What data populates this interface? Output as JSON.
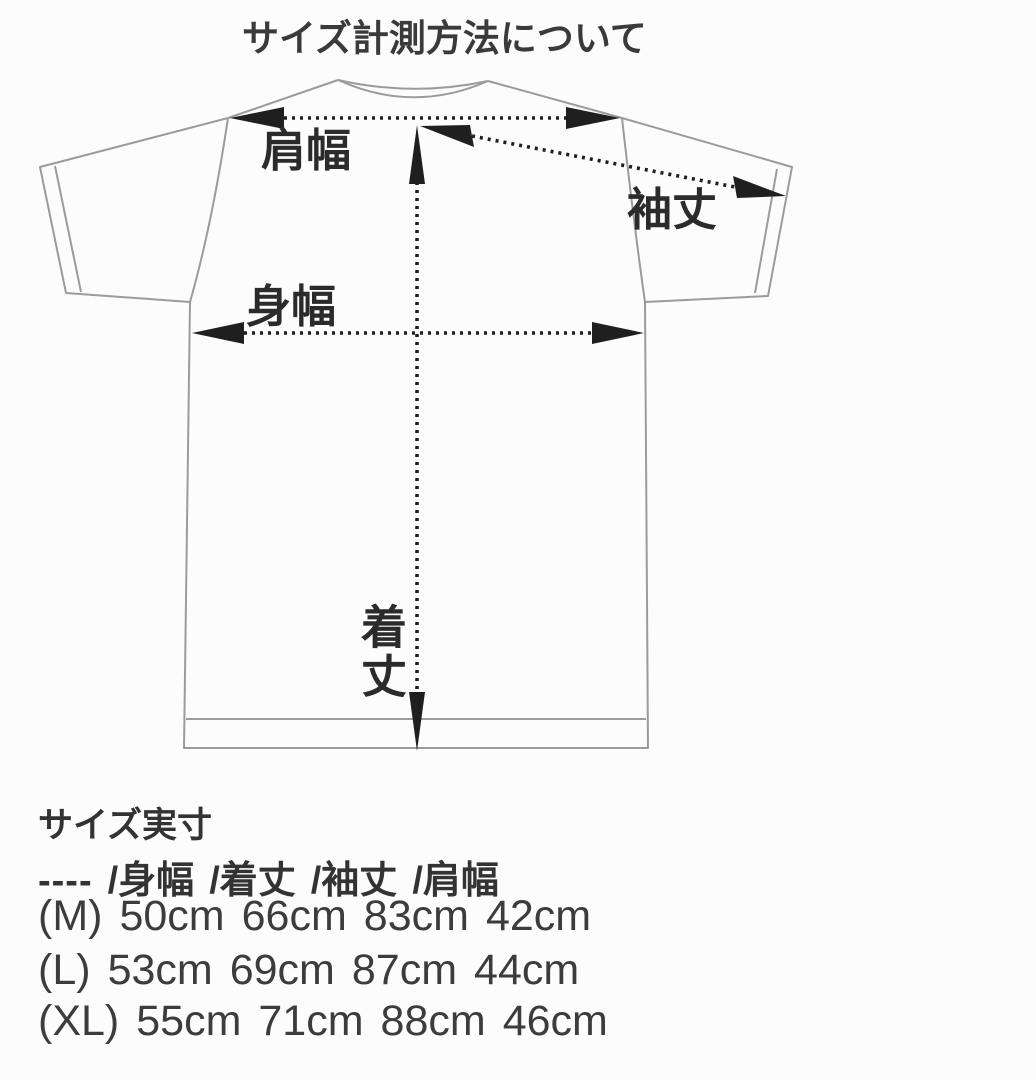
{
  "title": "サイズ計測方法について",
  "diagram": {
    "type": "tshirt-measurement-guide",
    "labels": {
      "shoulder_width": "肩幅",
      "sleeve_length": "袖丈",
      "body_width": "身幅",
      "body_length": "着丈"
    }
  },
  "size_table": {
    "heading": "サイズ実寸",
    "header": {
      "prefix": "----",
      "columns": [
        "/身幅",
        "/着丈",
        "/袖丈",
        "/肩幅"
      ]
    },
    "rows": [
      {
        "size": "(M)",
        "values": [
          "50cm",
          "66cm",
          "83cm",
          "42cm"
        ]
      },
      {
        "size": "(L)",
        "values": [
          "53cm",
          "69cm",
          "87cm",
          "44cm"
        ]
      },
      {
        "size": "(XL)",
        "values": [
          "55cm",
          "71cm",
          "88cm",
          "46cm"
        ]
      }
    ]
  },
  "colors": {
    "background": "#fcfcfc",
    "text": "#2e2e2e",
    "line_art": "#9b9b9b",
    "arrow": "#1f1f1f"
  }
}
